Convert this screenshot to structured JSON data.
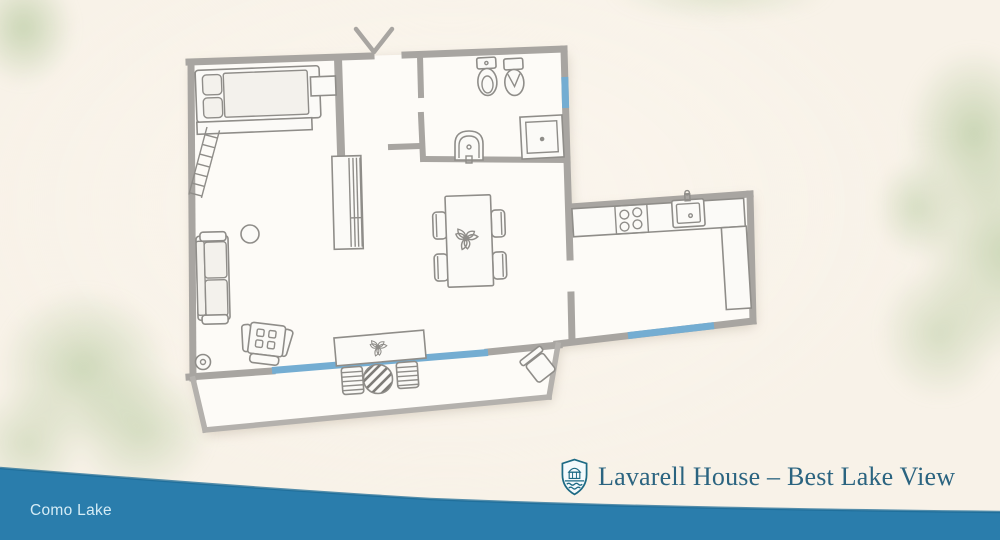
{
  "brand": {
    "title": "Lavarell House – Best Lake View",
    "logo_icon": "shield-house-lake-icon"
  },
  "lake": {
    "label": "Como Lake"
  },
  "colors": {
    "background": "#f8f2e8",
    "wall": "#a8a5a1",
    "terrace_wall": "#b4b1ad",
    "window": "#74add2",
    "furniture_stroke": "#8f8d89",
    "furniture_fill": "#fbfaf7",
    "floor": "#fdfbf7",
    "watercolor_green": "#a3be8a",
    "lake": "#2a7dac",
    "lake_edge": "#1e6b96",
    "title": "#2b6480",
    "lake_text": "#d5ecf6"
  },
  "floorplan": {
    "window_count": 3,
    "entrance_marker": "chevron-door-icon",
    "furniture_icons": [
      "bed-icon",
      "pillow-icon",
      "ladder-icon",
      "wardrobe-icon",
      "sofa-icon",
      "side-table-icon",
      "armchair-icon",
      "floor-lamp-icon",
      "console-table-icon",
      "dining-table-icon",
      "dining-chair-icon",
      "flower-centerpiece-icon",
      "kitchen-counter-icon",
      "stove-icon",
      "kitchen-sink-icon",
      "toilet-icon",
      "bidet-icon",
      "bathroom-sink-icon",
      "shower-icon",
      "terrace-stool-icon",
      "terrace-round-table-icon",
      "terrace-chair-icon"
    ]
  }
}
